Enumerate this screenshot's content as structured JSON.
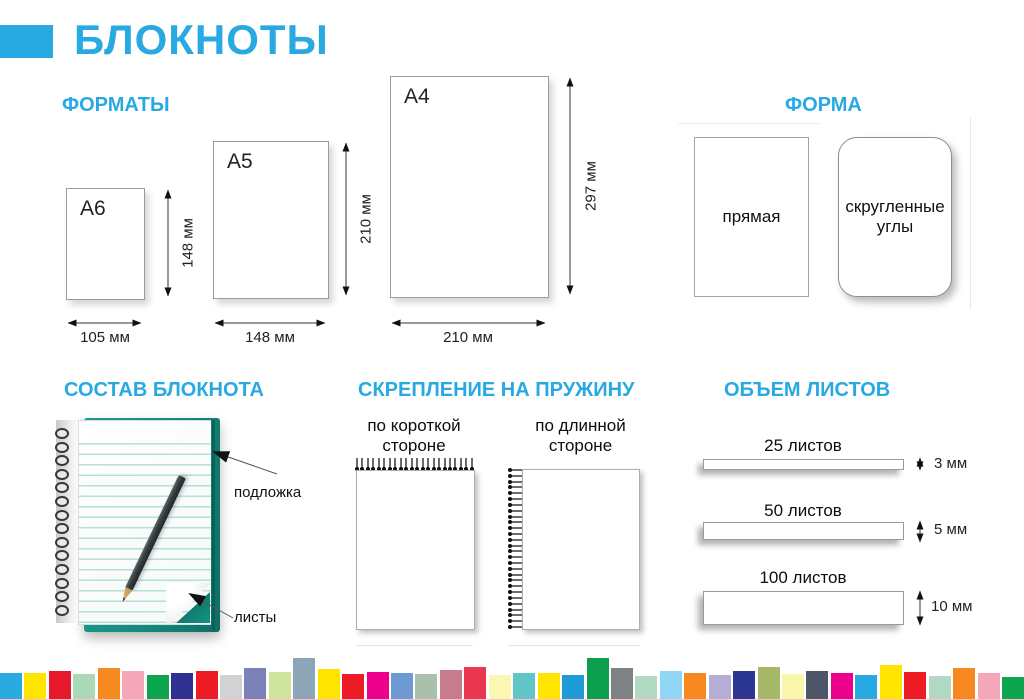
{
  "accent_color": "#29a9e1",
  "header": {
    "title": "БЛОКНОТЫ"
  },
  "formats": {
    "title": "ФОРМАТЫ",
    "sheets": [
      {
        "name": "А6",
        "width_label": "105 мм",
        "height_label": "148 мм"
      },
      {
        "name": "А5",
        "width_label": "148 мм",
        "height_label": "210 мм"
      },
      {
        "name": "А4",
        "width_label": "210 мм",
        "height_label": "297 мм"
      }
    ]
  },
  "shape": {
    "title": "ФОРМА",
    "options": [
      {
        "label": "прямая"
      },
      {
        "label": "скругленные углы"
      }
    ]
  },
  "composition": {
    "title": "СОСТАВ БЛОКНОТА",
    "labels": {
      "backing": "подложка",
      "sheets": "листы"
    },
    "backing_color": "#148a7f"
  },
  "binding": {
    "title": "СКРЕПЛЕНИЕ НА ПРУЖИНУ",
    "options": [
      {
        "label": "по короткой стороне"
      },
      {
        "label": "по длинной стороне"
      }
    ]
  },
  "volume": {
    "title": "ОБЪЕМ ЛИСТОВ",
    "items": [
      {
        "label": "25 листов",
        "thickness": "3 мм"
      },
      {
        "label": "50 листов",
        "thickness": "5 мм"
      },
      {
        "label": "100 листов",
        "thickness": "10 мм"
      }
    ]
  },
  "footer_strip": [
    {
      "color": "#29abe2",
      "height": 26
    },
    {
      "color": "#ffe400",
      "height": 26
    },
    {
      "color": "#e8192c",
      "height": 28
    },
    {
      "color": "#abd9b8",
      "height": 25
    },
    {
      "color": "#f6891f",
      "height": 31
    },
    {
      "color": "#f4a7b9",
      "height": 28
    },
    {
      "color": "#0da64f",
      "height": 24
    },
    {
      "color": "#2e3192",
      "height": 26
    },
    {
      "color": "#ed1c24",
      "height": 28
    },
    {
      "color": "#d0d2d3",
      "height": 24
    },
    {
      "color": "#7d81ba",
      "height": 31
    },
    {
      "color": "#cfe49c",
      "height": 27
    },
    {
      "color": "#8ca6b8",
      "height": 41
    },
    {
      "color": "#ffe400",
      "height": 30
    },
    {
      "color": "#ed1c24",
      "height": 25
    },
    {
      "color": "#ec008c",
      "height": 27
    },
    {
      "color": "#6d9ad3",
      "height": 26
    },
    {
      "color": "#a9c0ab",
      "height": 25
    },
    {
      "color": "#c97b8e",
      "height": 29
    },
    {
      "color": "#e8374e",
      "height": 32
    },
    {
      "color": "#f9f7b2",
      "height": 24
    },
    {
      "color": "#62c5c8",
      "height": 26
    },
    {
      "color": "#ffe400",
      "height": 26
    },
    {
      "color": "#1d9cd8",
      "height": 24
    },
    {
      "color": "#0ca04e",
      "height": 41
    },
    {
      "color": "#7f8284",
      "height": 31
    },
    {
      "color": "#b2d9c4",
      "height": 23
    },
    {
      "color": "#90d7f7",
      "height": 28
    },
    {
      "color": "#f6891f",
      "height": 26
    },
    {
      "color": "#b4aed7",
      "height": 24
    },
    {
      "color": "#2b3691",
      "height": 28
    },
    {
      "color": "#a6b969",
      "height": 32
    },
    {
      "color": "#f8f6ab",
      "height": 25
    },
    {
      "color": "#4d5668",
      "height": 28
    },
    {
      "color": "#ec008c",
      "height": 26
    },
    {
      "color": "#27aae1",
      "height": 24
    },
    {
      "color": "#ffe400",
      "height": 34
    },
    {
      "color": "#ed1c24",
      "height": 27
    },
    {
      "color": "#b2d9c4",
      "height": 23
    },
    {
      "color": "#f6891f",
      "height": 31
    },
    {
      "color": "#f4a7b9",
      "height": 26
    },
    {
      "color": "#0da64f",
      "height": 22
    }
  ]
}
